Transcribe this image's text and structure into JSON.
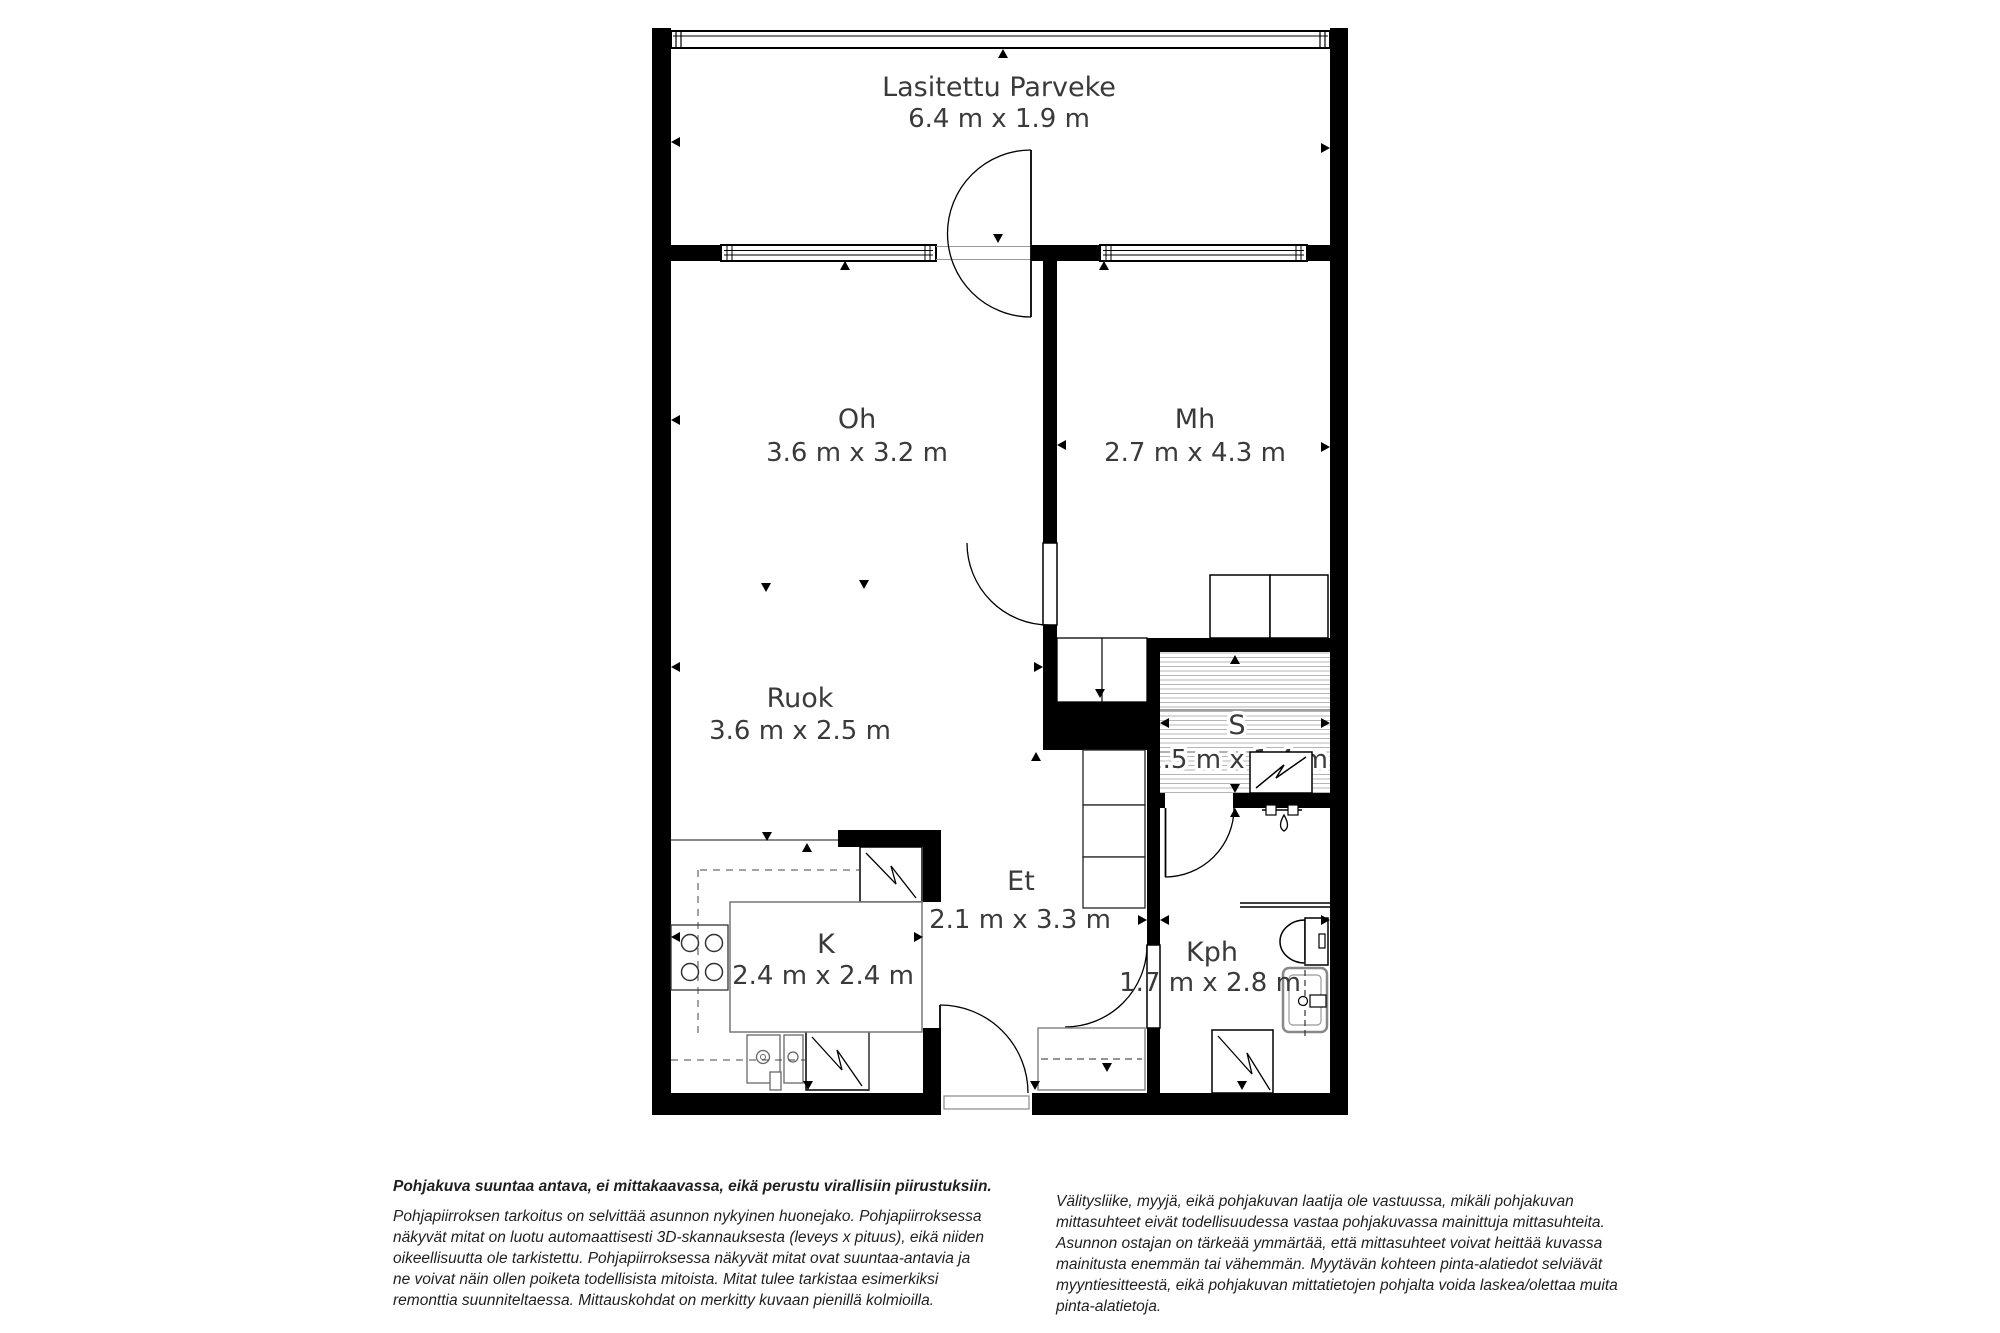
{
  "plan": {
    "rooms": {
      "balcony": {
        "name": "Lasitettu Parveke",
        "dims": "6.4 m x 1.9 m"
      },
      "oh": {
        "name": "Oh",
        "dims": "3.6 m x 3.2 m"
      },
      "mh": {
        "name": "Mh",
        "dims": "2.7 m x 4.3 m"
      },
      "ruok": {
        "name": "Ruok",
        "dims": "3.6 m x 2.5 m"
      },
      "s": {
        "name": "S",
        "dims": "1.5 m x 1.4 m"
      },
      "et": {
        "name": "Et",
        "dims": "2.1 m x 3.3 m"
      },
      "k": {
        "name": "K",
        "dims": "2.4 m x 2.4 m"
      },
      "kph": {
        "name": "Kph",
        "dims": "1.7 m x 2.8 m"
      }
    }
  },
  "disclaimers": {
    "bold_note": "Pohjakuva suuntaa antava, ei mittakaavassa, eikä perustu virallisiin piirustuksiin.",
    "left_paragraph": "Pohjapiirroksen tarkoitus on selvittää asunnon nykyinen huonejako. Pohjapiirroksessa\nnäkyvät mitat on luotu automaattisesti 3D-skannauksesta (leveys x pituus), eikä niiden\noikeellisuutta ole tarkistettu. Pohjapiirroksessa näkyvät mitat ovat suuntaa-antavia ja\nne voivat näin ollen poiketa todellisista mitoista. Mitat tulee tarkistaa esimerkiksi\nremonttia suunniteltaessa. Mittauskohdat on merkitty kuvaan pienillä kolmioilla.",
    "right_paragraph": "Välitysliike, myyjä, eikä pohjakuvan laatija ole vastuussa, mikäli pohjakuvan\nmittasuhteet eivät todellisuudessa vastaa pohjakuvassa mainittuja mittasuhteita.\nAsunnon ostajan on tärkeää ymmärtää, että mittasuhteet voivat heittää kuvassa\nmainitusta enemmän tai vähemmän. Myytävän kohteen pinta-alatiedot selviävät\nmyyntiesitteestä, eikä pohjakuvan mittatietojen pohjalta voida laskea/olettaa muita\npinta-alatietoja."
  },
  "colors": {
    "wall": "#000000",
    "label": "#3a3a3a",
    "hatch": "#b5b5b5"
  }
}
